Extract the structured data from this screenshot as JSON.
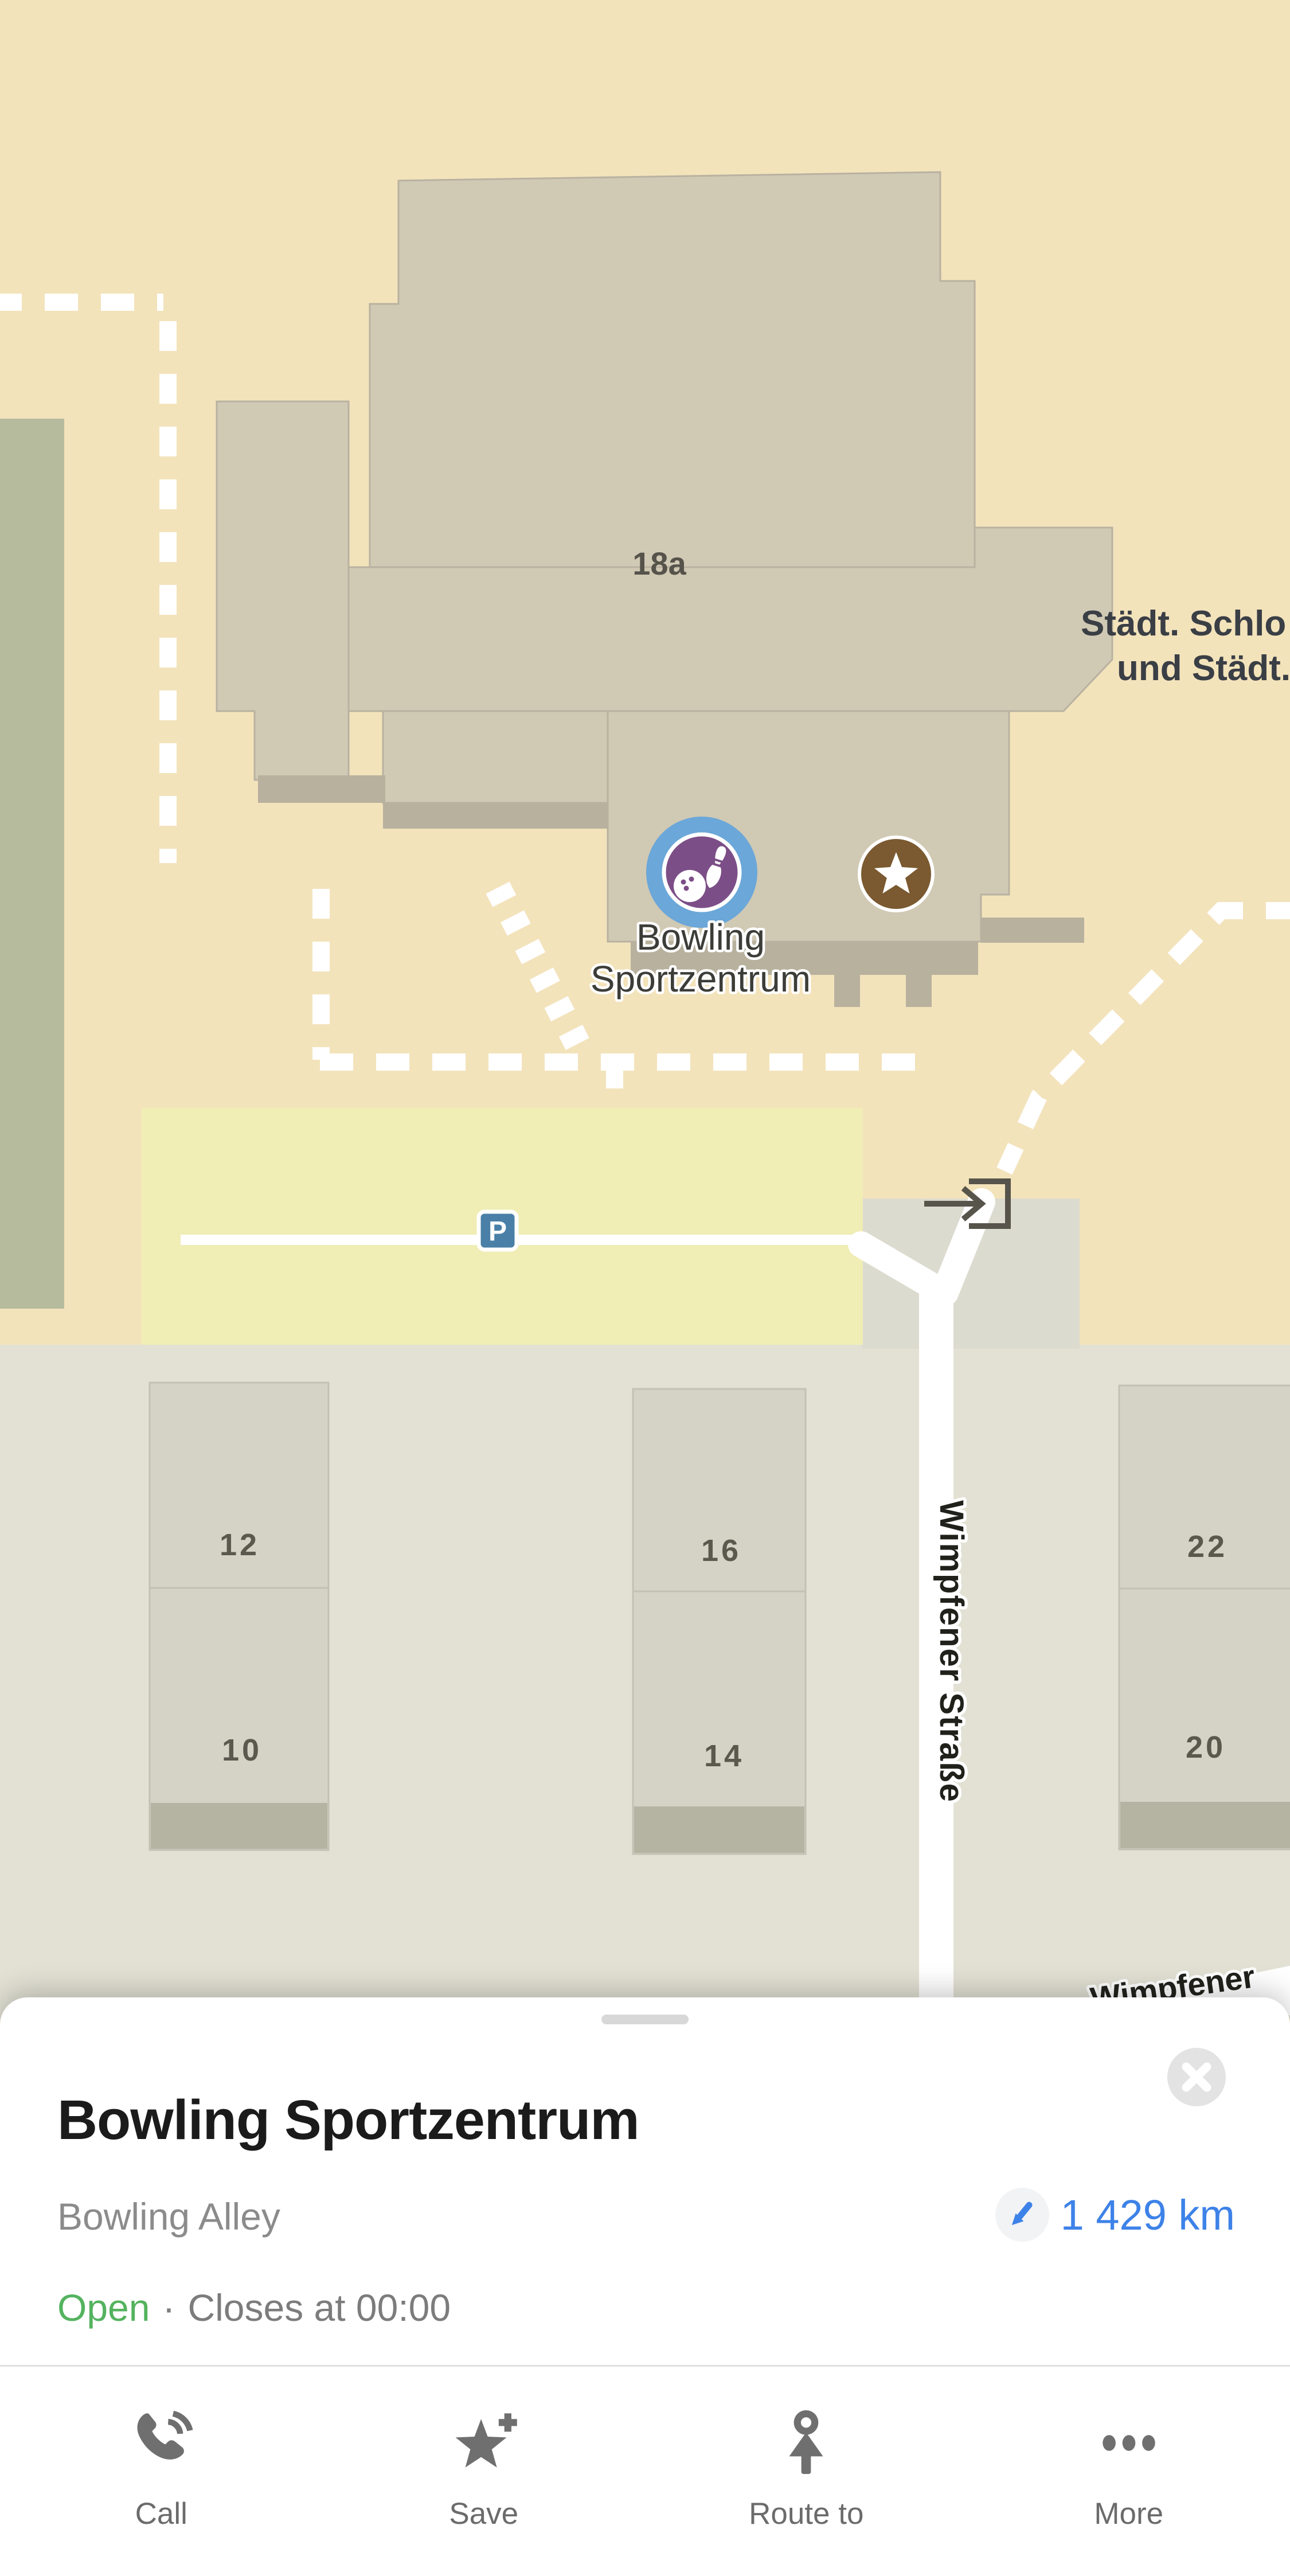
{
  "map": {
    "building_number": "18a",
    "right_building_label": {
      "line1": "Städt. Schlo",
      "line2": "und Städt."
    },
    "poi_label": {
      "line1": "Bowling",
      "line2": "Sportzentrum"
    },
    "street_vertical": "Wimpfener Straße",
    "street_bottom": "Wimpfener",
    "parking_badge": "P",
    "house_numbers": {
      "b1_top": "12",
      "b1_bottom": "10",
      "b2_top": "16",
      "b2_bottom": "14",
      "b3_top": "22",
      "b3_bottom": "20"
    },
    "colors": {
      "map_background": "#f3e3bb",
      "building": "#d0c9b4",
      "building_base": "#b8b19e",
      "parking_area": "#f0edb5",
      "green_area": "#b6bb9e",
      "residential_area": "#e2e1d4",
      "poi_marker_blue": "#6ba7d9",
      "poi_marker_purple": "#7c4e87",
      "favorite_marker_brown": "#7b5a31",
      "parking_blue": "#4a80a7"
    }
  },
  "sheet": {
    "title": "Bowling Sportzentrum",
    "category": "Bowling Alley",
    "distance": "1 429 km",
    "status": {
      "open": "Open",
      "separator": "·",
      "hours": "Closes at 00:00"
    },
    "actions": {
      "call": "Call",
      "save": "Save",
      "route": "Route to",
      "more": "More"
    },
    "colors": {
      "distance_blue": "#3d82e8",
      "open_green": "#54b35f"
    }
  }
}
